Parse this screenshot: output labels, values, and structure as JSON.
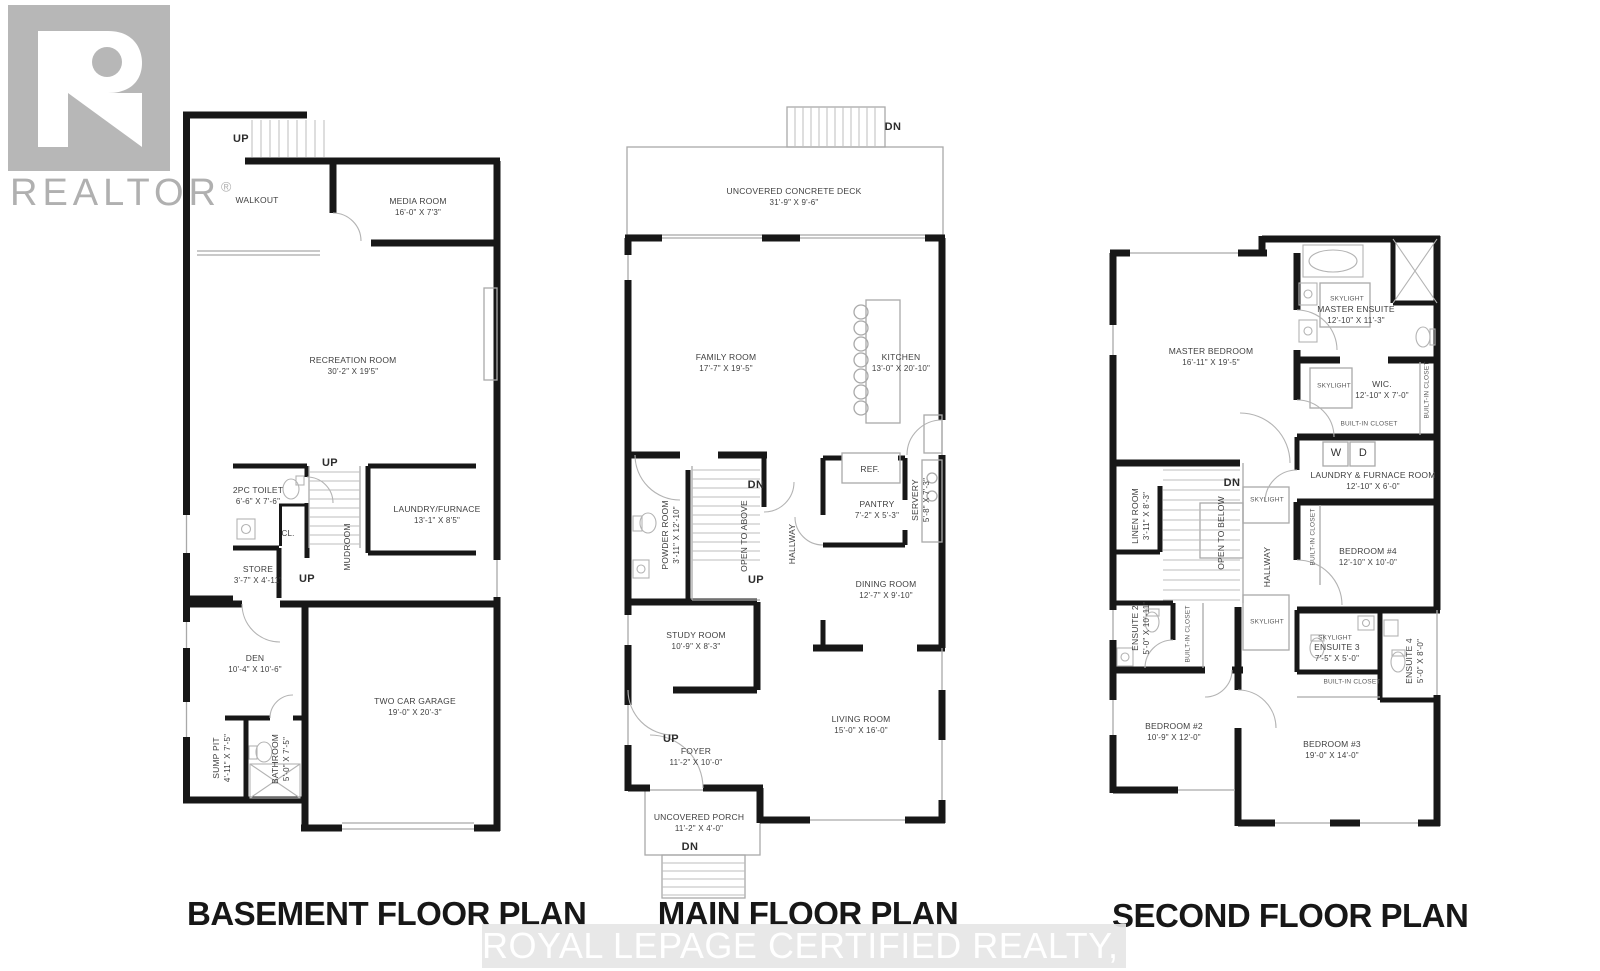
{
  "branding": {
    "logo_text": "REALTOR",
    "logo_reg_mark": "®",
    "watermark_text": "ROYAL LEPAGE CERTIFIED REALTY, Brokerage"
  },
  "shared": {
    "up": "UP",
    "dn": "DN",
    "skylight": "SKYLIGHT",
    "built_in_closet": "BUILT-IN CLOSET"
  },
  "basement": {
    "title": "BASEMENT FLOOR PLAN",
    "labels": {
      "cl": "CL."
    },
    "rooms": {
      "walkout": {
        "name": "WALKOUT"
      },
      "media": {
        "name": "MEDIA ROOM",
        "dims": "16'-0\" X 7'3\""
      },
      "recreation": {
        "name": "RECREATION ROOM",
        "dims": "30'-2\" X 19'5\""
      },
      "toilet_2pc": {
        "name": "2PC TOILET",
        "dims": "6'-6\" X 7'-6\""
      },
      "laundry_furnace": {
        "name": "LAUNDRY/FURNACE",
        "dims": "13'-1\" X 8'5\""
      },
      "store": {
        "name": "STORE",
        "dims": "3'-7\" X 4'-11\""
      },
      "mudroom": {
        "name": "MUDROOM"
      },
      "den": {
        "name": "DEN",
        "dims": "10'-4\" X 10'-6\""
      },
      "sump_pit": {
        "name": "SUMP PIT",
        "dims": "4'-11\" X 7'-5\""
      },
      "bathroom": {
        "name": "BATHROOM",
        "dims": "5'-0\" X 7'-5\""
      },
      "garage": {
        "name": "TWO CAR GARAGE",
        "dims": "19'-0\" X 20'-3\""
      }
    }
  },
  "main": {
    "title": "MAIN FLOOR PLAN",
    "labels": {
      "ref": "REF."
    },
    "rooms": {
      "deck": {
        "name": "UNCOVERED CONCRETE DECK",
        "dims": "31'-9\" X 9'-6\""
      },
      "family": {
        "name": "FAMILY ROOM",
        "dims": "17'-7\" X 19'-5\""
      },
      "kitchen": {
        "name": "KITCHEN",
        "dims": "13'-0\" X 20'-10\""
      },
      "pantry": {
        "name": "PANTRY",
        "dims": "7'-2\" X 5'-3\""
      },
      "servery": {
        "name": "SERVERY",
        "dims": "5'-8\" X 7'-3\""
      },
      "powder": {
        "name": "POWDER ROOM",
        "dims": "3'-11\" X 12'-10\""
      },
      "open_above": {
        "name": "OPEN TO ABOVE"
      },
      "hallway": {
        "name": "HALLWAY"
      },
      "dining": {
        "name": "DINING ROOM",
        "dims": "12'-7\" X 9'-10\""
      },
      "study": {
        "name": "STUDY ROOM",
        "dims": "10'-9\" X 8'-3\""
      },
      "living": {
        "name": "LIVING ROOM",
        "dims": "15'-0\" X 16'-0\""
      },
      "foyer": {
        "name": "FOYER",
        "dims": "11'-2\" X 10'-0\""
      },
      "porch": {
        "name": "UNCOVERED PORCH",
        "dims": "11'-2\" X 4'-0\""
      }
    }
  },
  "second": {
    "title": "SECOND FLOOR PLAN",
    "labels": {
      "w": "W",
      "d": "D"
    },
    "rooms": {
      "master": {
        "name": "MASTER BEDROOM",
        "dims": "16'-11\" X 19'-5\""
      },
      "master_ensuite": {
        "name": "MASTER ENSUITE",
        "dims": "12'-10\" X 11'-3\""
      },
      "wic": {
        "name": "WIC.",
        "dims": "12'-10\" X 7'-0\""
      },
      "laundry": {
        "name": "LAUNDRY & FURNACE ROOM",
        "dims": "12'-10\" X 6'-0\""
      },
      "linen": {
        "name": "LINEN ROOM",
        "dims": "3'-11\" X 8'-3\""
      },
      "open_below": {
        "name": "OPEN TO BELOW"
      },
      "hallway": {
        "name": "HALLWAY"
      },
      "bed4": {
        "name": "BEDROOM #4",
        "dims": "12'-10\" X 10'-0\""
      },
      "ensuite2": {
        "name": "ENSUITE 2",
        "dims": "5'-0\" X 10'-11\""
      },
      "ensuite3": {
        "name": "ENSUITE 3",
        "dims": "7'-5\" X 5'-0\""
      },
      "ensuite4": {
        "name": "ENSUITE 4",
        "dims": "5'-0\" X 8'-0\""
      },
      "bed2": {
        "name": "BEDROOM #2",
        "dims": "10'-9\" X 12'-0\""
      },
      "bed3": {
        "name": "BEDROOM #3",
        "dims": "19'-0\" X 14'-0\""
      }
    }
  }
}
